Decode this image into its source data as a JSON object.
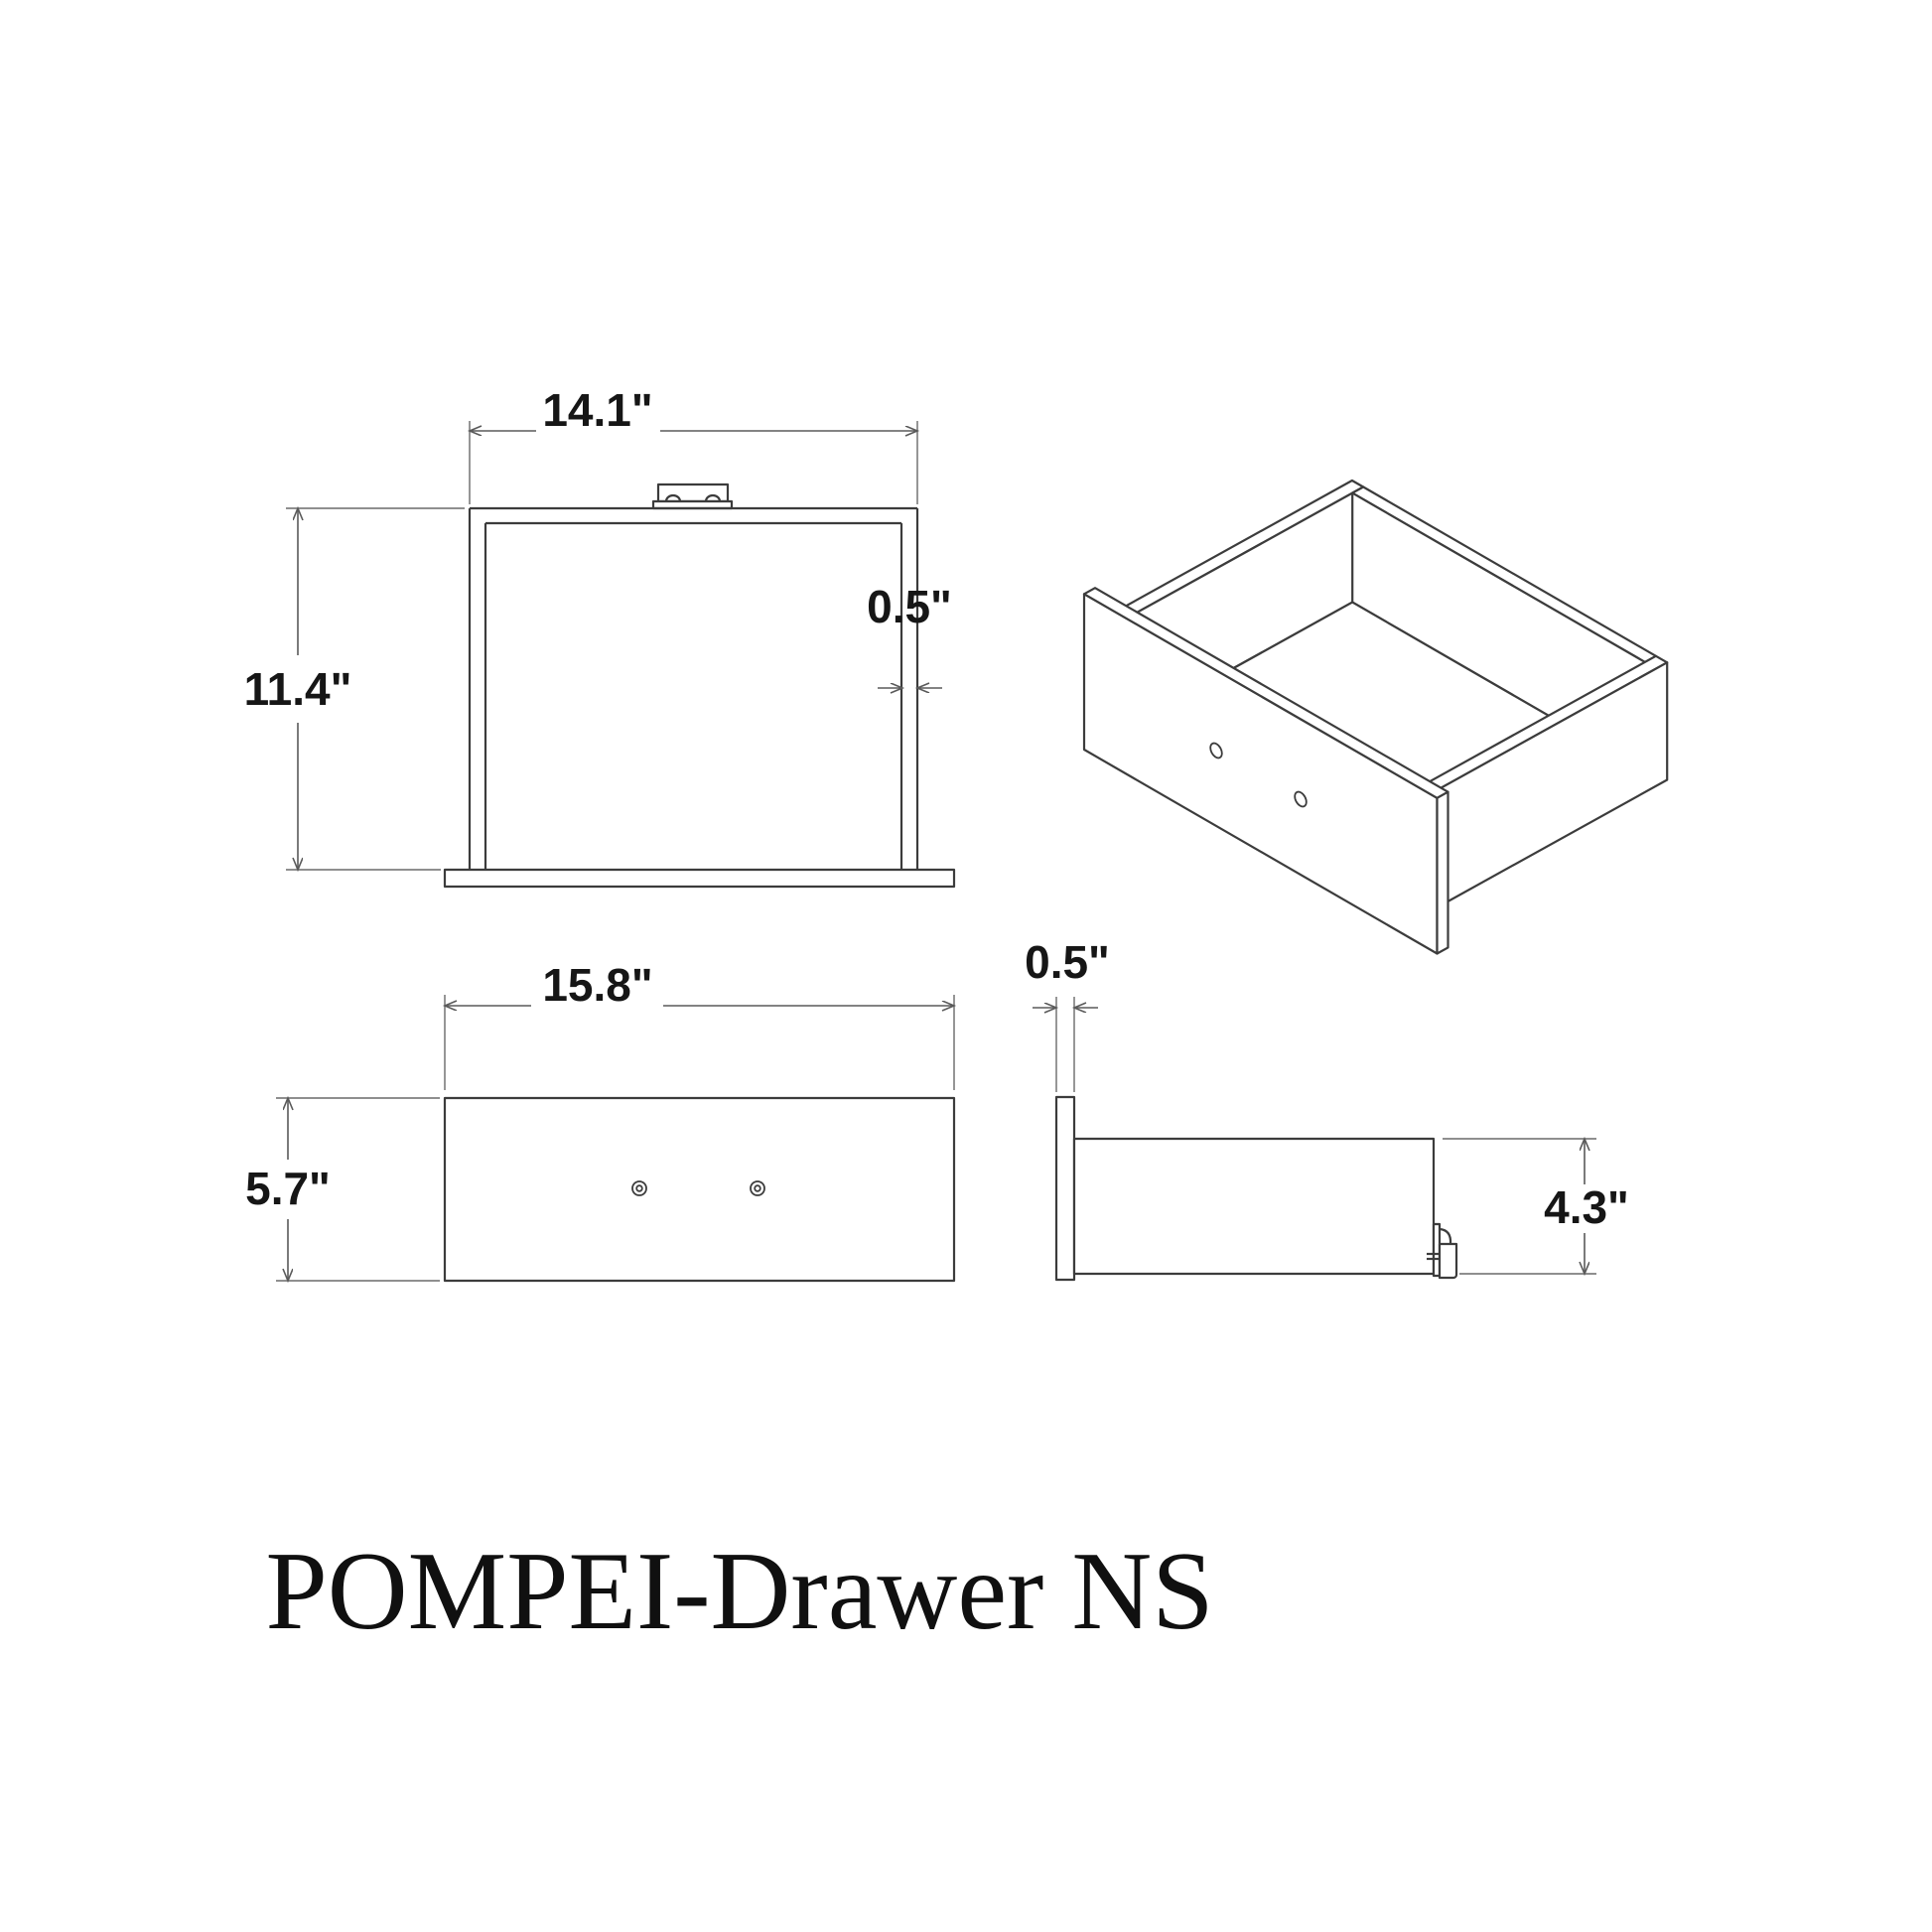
{
  "title": "POMPEI-Drawer NS",
  "views": {
    "top_view": {
      "name": "top view",
      "width_label": "14.1\"",
      "depth_label": "11.4\"",
      "wall_thickness_label": "0.5\""
    },
    "front_view": {
      "name": "front view",
      "width_label": "15.8\"",
      "height_label": "5.7\""
    },
    "side_view": {
      "name": "side view",
      "panel_thickness_label": "0.5\"",
      "height_label": "4.3\""
    },
    "isometric_view": {
      "name": "isometric view"
    }
  }
}
